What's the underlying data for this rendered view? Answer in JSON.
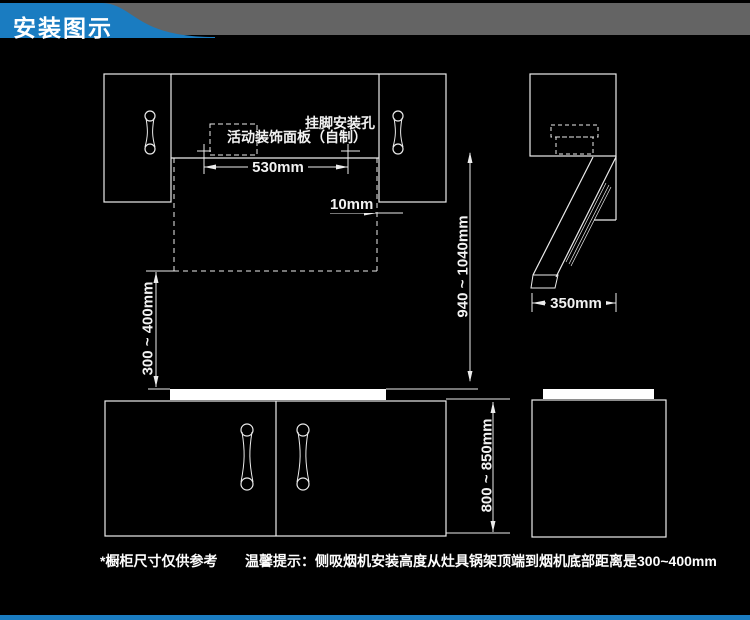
{
  "header": {
    "title": "安装图示"
  },
  "colors": {
    "accent_blue": "#1a7cc1",
    "band_gray": "#646464",
    "line_white": "#ececec",
    "background": "#000000"
  },
  "front_view": {
    "labels": {
      "mounting_holes": "挂脚安装孔",
      "decorative_panel": "活动装饰面板（自制）"
    },
    "dimensions": {
      "hole_spacing": "530mm",
      "cabinet_gap": "10mm",
      "hood_bottom_to_counter": "300 ~ 400mm",
      "holes_to_counter": "940 ~ 1040mm",
      "base_cabinet_height": "800 ~ 850mm"
    }
  },
  "side_view": {
    "dimensions": {
      "hood_depth": "350mm"
    }
  },
  "footer": {
    "note": "*橱柜尺寸仅供参考",
    "tip": "温馨提示：侧吸烟机安装高度从灶具锅架顶端到烟机底部距离是300~400mm"
  }
}
